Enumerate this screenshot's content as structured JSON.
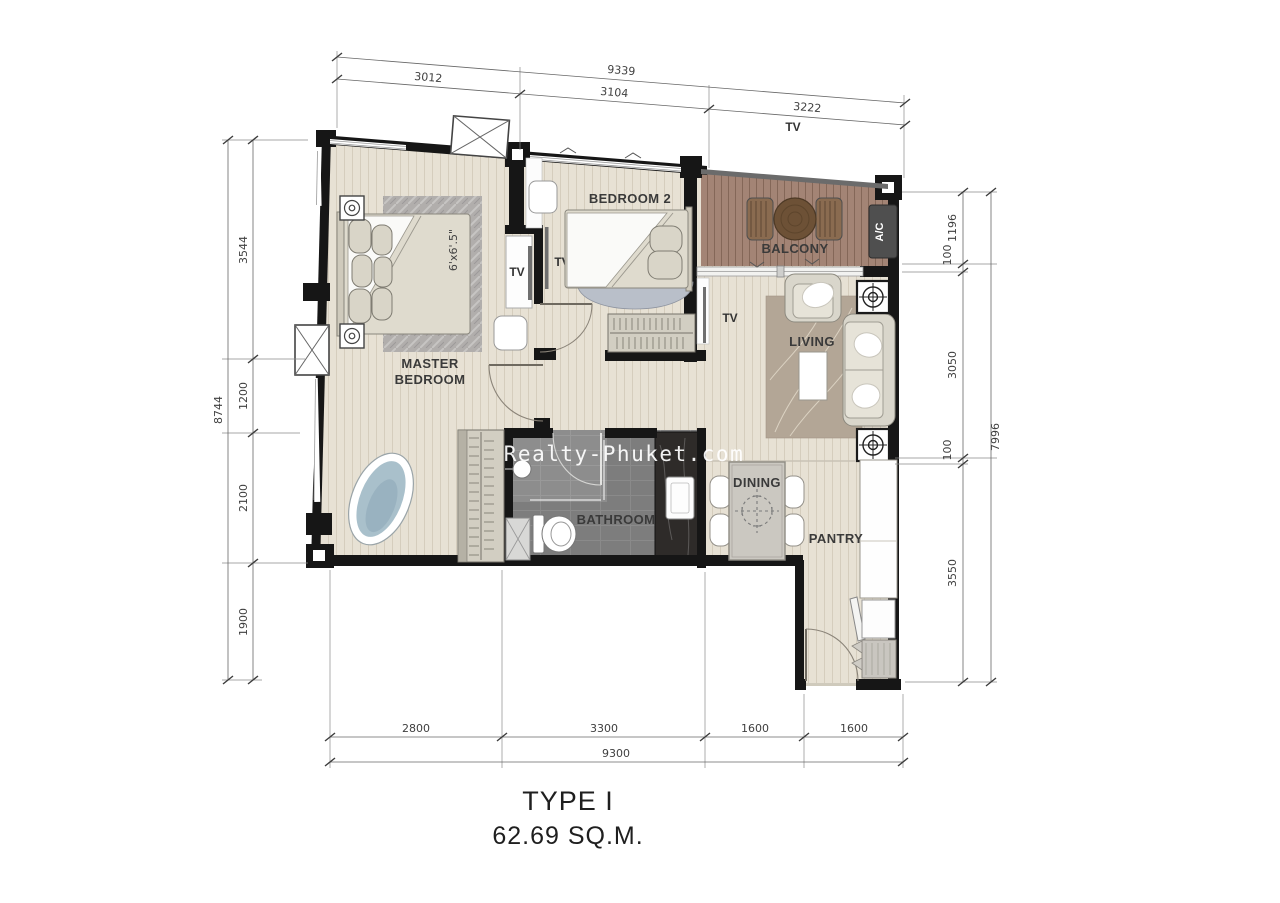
{
  "title": {
    "line1": "TYPE I",
    "line2": "62.69 SQ.M."
  },
  "watermark": "Realty-Phuket.com",
  "rooms": {
    "master_line1": "MASTER",
    "master_line2": "BEDROOM",
    "bedroom2": "BEDROOM 2",
    "balcony": "BALCONY",
    "living": "LIVING",
    "bathroom": "BATHROOM",
    "dining": "DINING",
    "pantry": "PANTRY"
  },
  "labels": {
    "ac": "A/C",
    "tv": "TV",
    "bed_size": "6'x6'.5\""
  },
  "dimensions": {
    "top": {
      "total": "9339",
      "segments": [
        "3012",
        "3104",
        "3222"
      ]
    },
    "left": {
      "total": "8744",
      "segments": [
        "3544",
        "1200",
        "2100",
        "1900"
      ]
    },
    "right": {
      "total": "7996",
      "segments": [
        "1196",
        "100",
        "3050",
        "100",
        "3550"
      ]
    },
    "bottom": {
      "total": "9300",
      "segments": [
        "2800",
        "3300",
        "1600",
        "1600"
      ]
    }
  },
  "colors": {
    "wall": "#161616",
    "floor": "#e7e1d4",
    "balcony_deck": "#a38475",
    "bathroom_tile": "#7d7d7d",
    "marble": "#2e2b29"
  }
}
